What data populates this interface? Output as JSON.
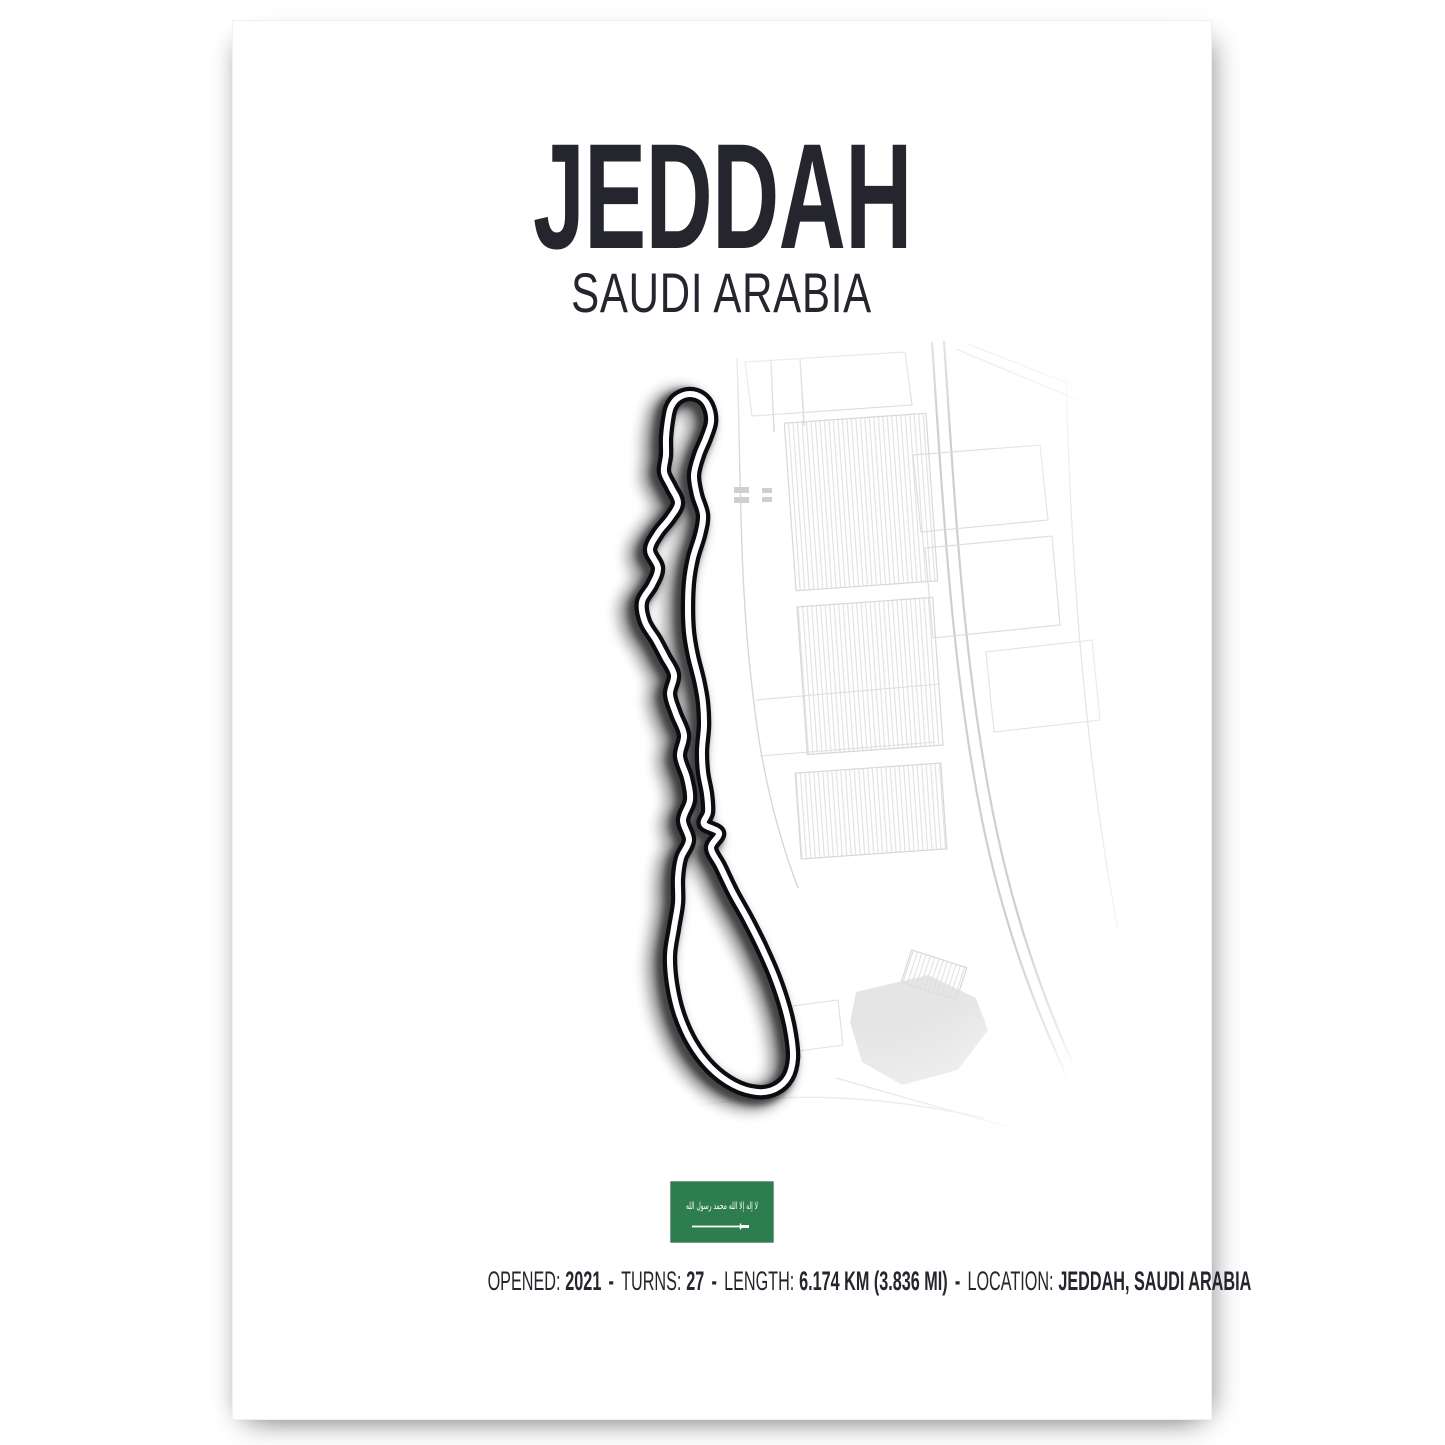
{
  "poster": {
    "title": "JEDDAH",
    "subtitle": "SAUDI ARABIA",
    "stats": [
      {
        "label": "OPENED:",
        "value": "2021"
      },
      {
        "label": "TURNS:",
        "value": "27"
      },
      {
        "label": "LENGTH:",
        "value": "6.174 KM (3.836 MI)"
      },
      {
        "label": "LOCATION:",
        "value": "JEDDAH, SAUDI ARABIA"
      }
    ],
    "separator": "-",
    "flag": {
      "country": "Saudi Arabia",
      "shahada": "لا إله إلا الله محمد رسول الله"
    },
    "colors": {
      "ink": "#25252d",
      "flag_green": "#2e7d4f",
      "map_line": "#d7d7d7",
      "track": "#0c0c12"
    }
  }
}
